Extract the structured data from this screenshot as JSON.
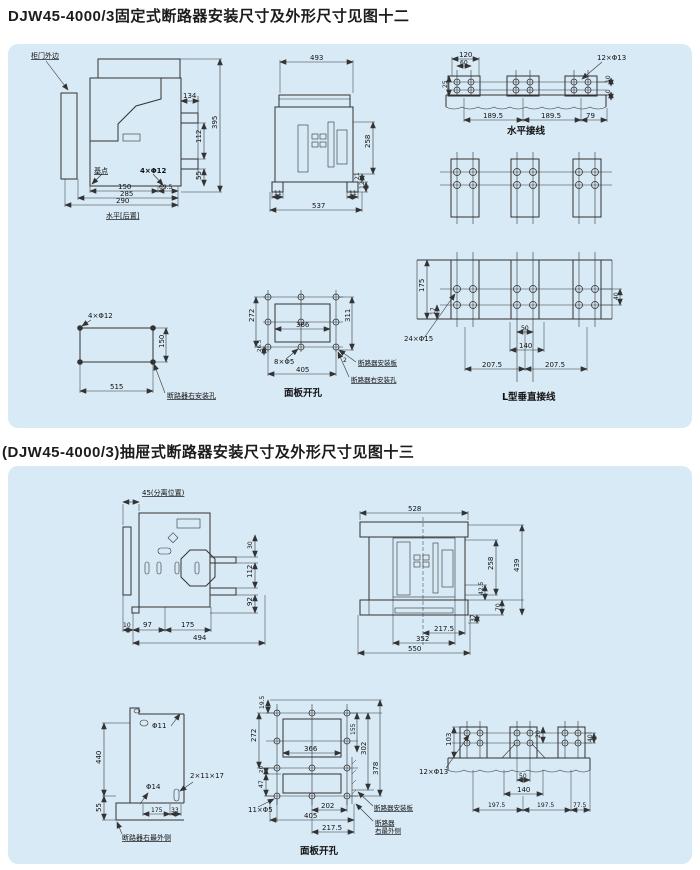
{
  "titles": {
    "fig12": "DJW45-4000/3固定式断路器安装尺寸及外形尺寸见图十二",
    "fig13": "(DJW45-4000/3)抽屉式断路器安装尺寸及外形尺寸见图十三"
  },
  "colors": {
    "panel_bg": "#d8eaf6",
    "line": "#333333"
  },
  "fig12": {
    "side": {
      "door": "柜门外边",
      "base": "基点",
      "holes": "4×Φ12",
      "caption": "水平[后置]",
      "d134": "134",
      "d395": "395",
      "d112": "112",
      "d55": "55",
      "d150": "150",
      "d695": "69.5",
      "d285": "285",
      "d290": "290"
    },
    "front": {
      "d493": "493",
      "d258": "258",
      "d21": "21",
      "d12": "12",
      "d11l": "11",
      "d11r": "11",
      "d537": "537"
    },
    "bus_h": {
      "caption": "水平接线",
      "holes": "12×Φ13",
      "d120": "120",
      "d60": "60",
      "d25": "25",
      "d10a": "10",
      "d10b": "10",
      "d189a": "189.5",
      "d189b": "189.5",
      "d79": "79"
    },
    "mount": {
      "holes": "4×Φ12",
      "d150": "150",
      "d515": "515",
      "label": "断路器右安装孔"
    },
    "panel_cut": {
      "caption": "面板开孔",
      "holes": "8×Φ5",
      "d272": "272",
      "d366": "366",
      "d311": "311",
      "d265": "26.5",
      "d405": "405",
      "d2": "2",
      "plate": "断路器安装板",
      "hole": "断路器右安装孔"
    },
    "bus_l": {
      "caption": "L型垂直接线",
      "holes": "24×Φ15",
      "d175": "175",
      "d17": "17",
      "d50": "50",
      "d140": "140",
      "d207a": "207.5",
      "d207b": "207.5",
      "d40": "40"
    }
  },
  "fig13": {
    "side": {
      "pos": "45(分离位置)",
      "d30": "30",
      "d112": "112",
      "d92": "92",
      "d10": "10",
      "d97": "97",
      "d175": "175",
      "d494": "494"
    },
    "front": {
      "d528": "528",
      "d439": "439",
      "d258": "258",
      "d425": "42.5",
      "d70": "70",
      "d37": "37",
      "d2175": "217.5",
      "d352": "352",
      "d550": "550"
    },
    "detail": {
      "d440": "440",
      "d55": "55",
      "phi11": "Φ11",
      "phi14": "Φ14",
      "slot": "2×11×17",
      "d175": "175",
      "d33": "33",
      "label": "断路器右最外侧"
    },
    "panel_cut": {
      "caption": "面板开孔",
      "holes": "11×Φ5",
      "d195": "19.5",
      "d272": "272",
      "d20": "20",
      "d47": "47",
      "d155": "155",
      "d302": "302",
      "d378": "378",
      "d366": "366",
      "d202": "202",
      "d405": "405",
      "d2175": "217.5",
      "plate": "断路器安装板",
      "edge1": "断路器",
      "edge2": "右最外侧"
    },
    "bus_v": {
      "holes": "12×Φ13",
      "d103": "103",
      "d20": "20",
      "d40": "40",
      "d50": "50",
      "d140": "140",
      "d197a": "197.5",
      "d197b": "197.5",
      "d775": "77.5"
    }
  }
}
